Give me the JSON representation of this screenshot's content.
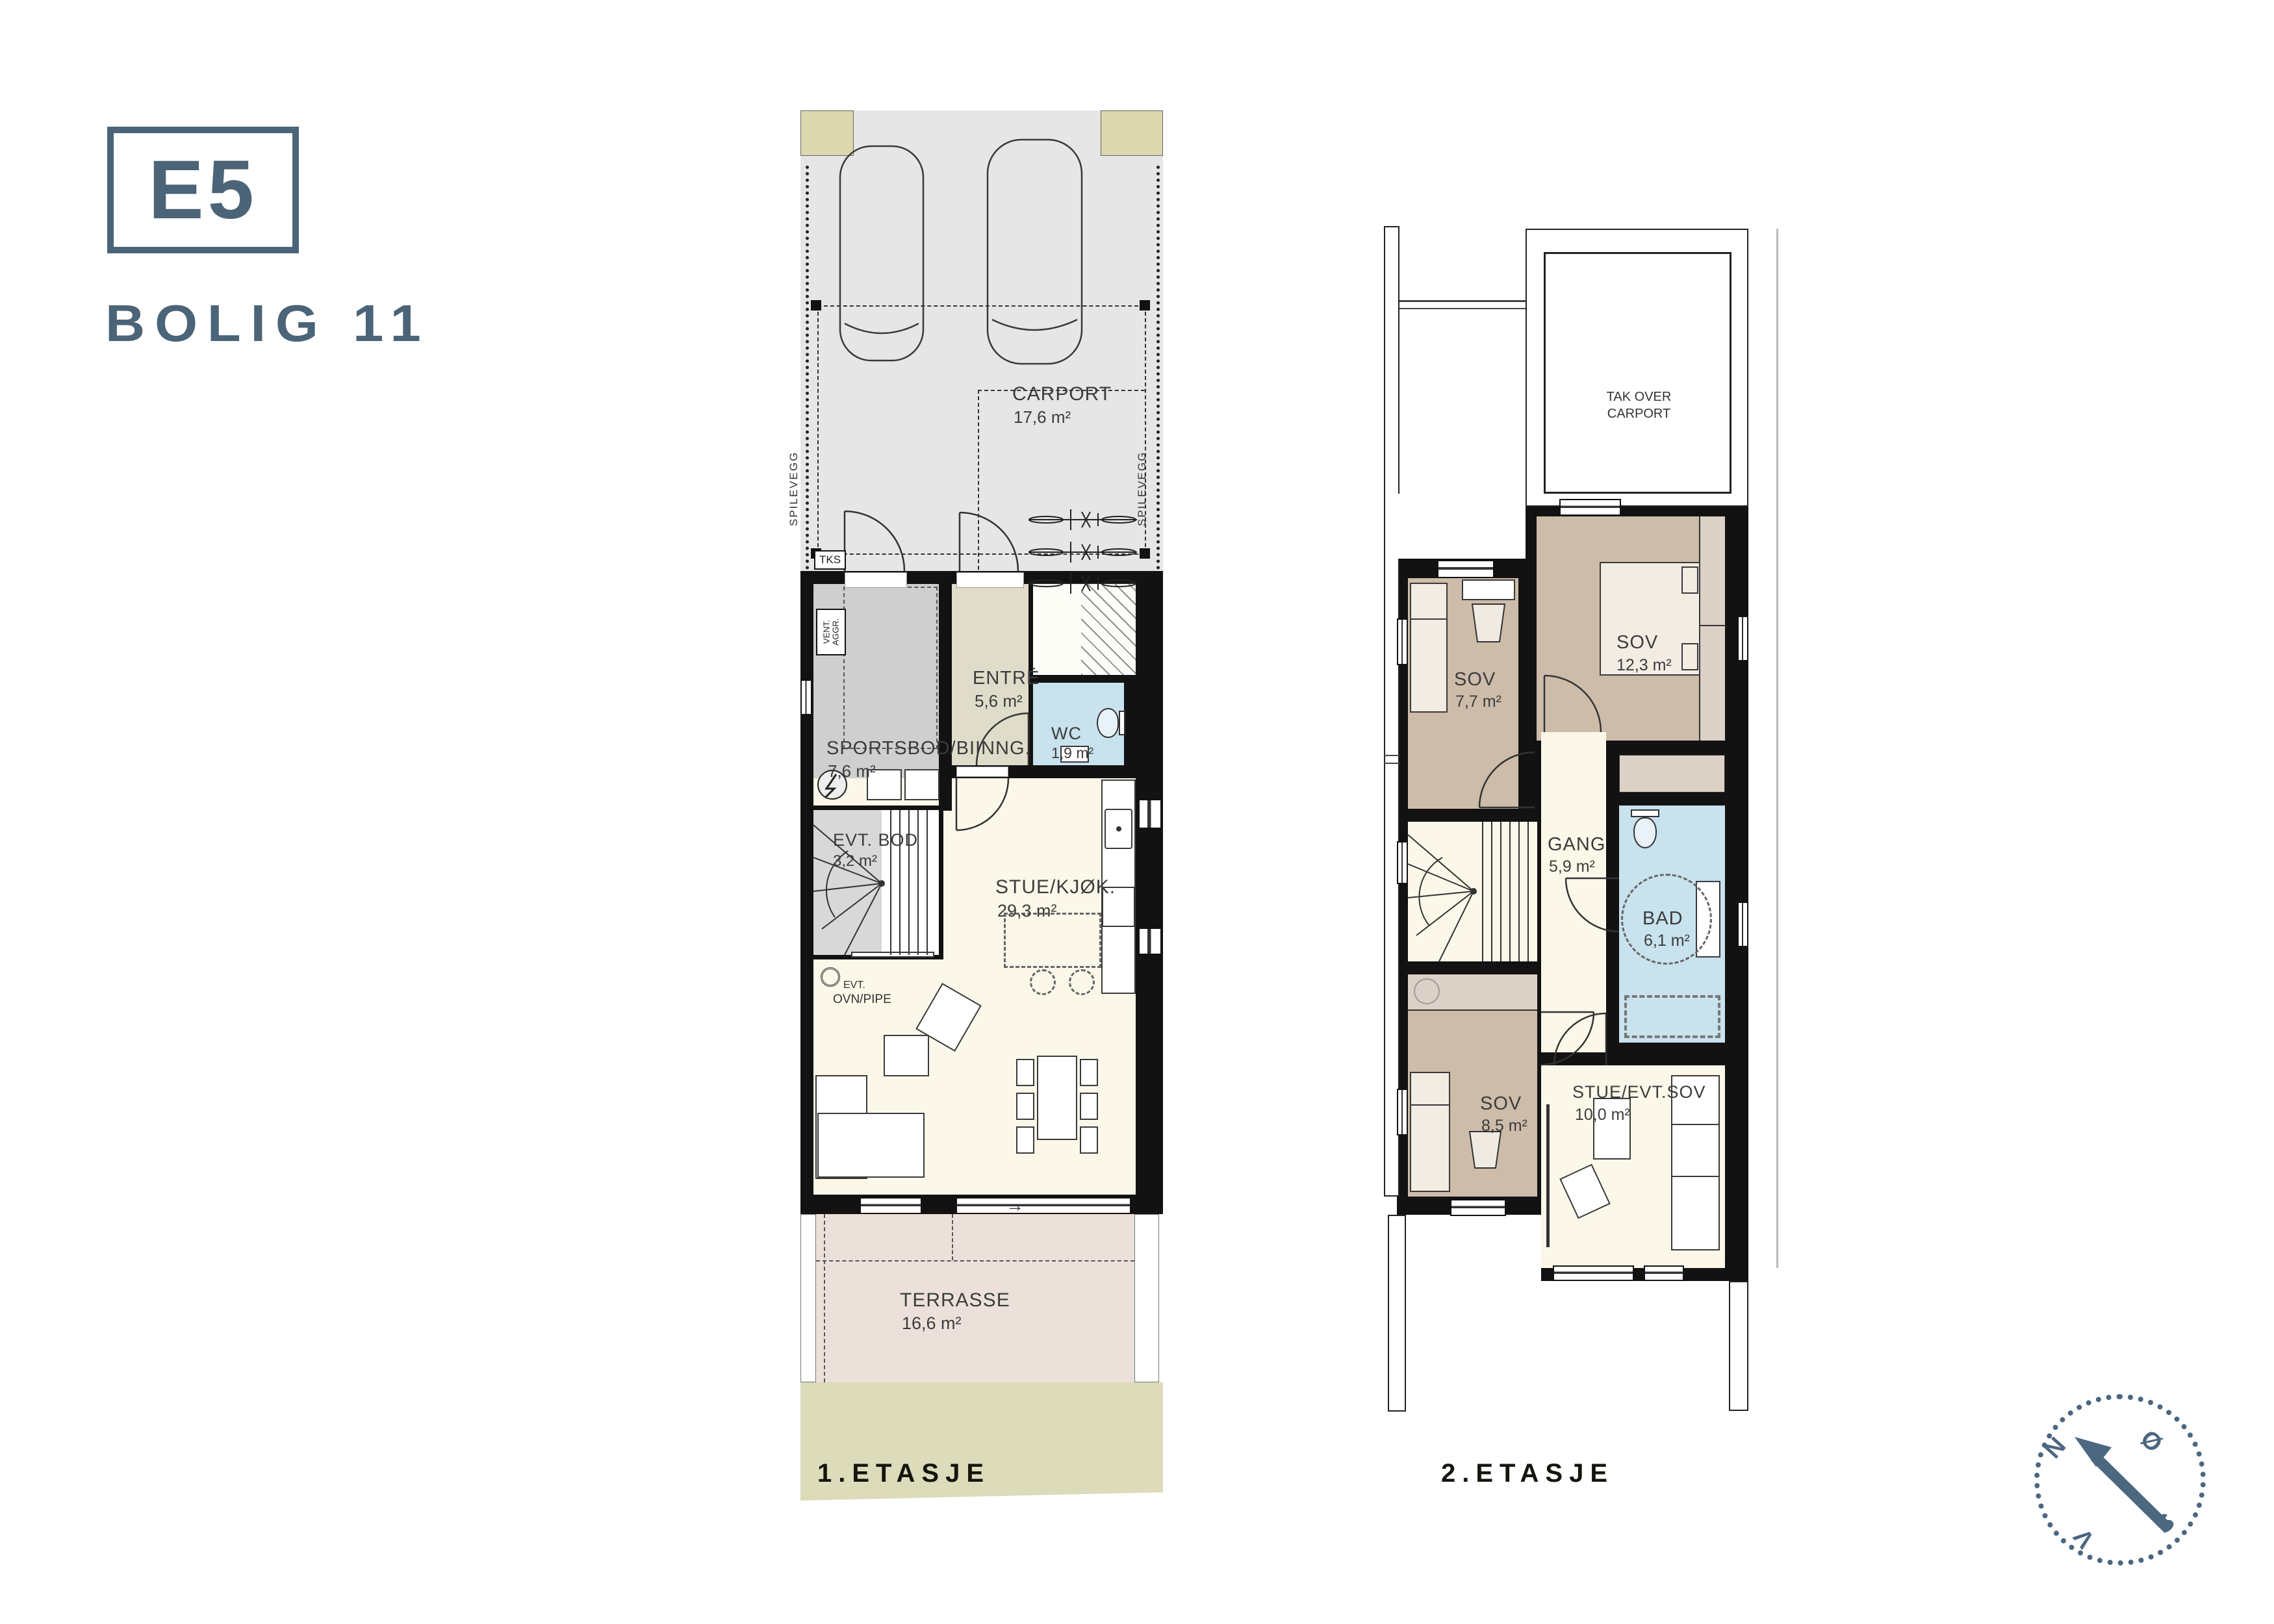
{
  "header": {
    "unit_code": "E5",
    "project_label": "BOLIG 11"
  },
  "floor1": {
    "label": "1.ETASJE",
    "rooms": {
      "carport": {
        "name": "CARPORT",
        "area": "17,6 m²"
      },
      "sportsbod": {
        "name": "SPORTSBOD/BIINNG.",
        "area": "7,6 m²"
      },
      "entre": {
        "name": "ENTRÉ",
        "area": "5,6 m²"
      },
      "wc": {
        "name": "WC",
        "area": "1,9 m²"
      },
      "evt_bod": {
        "name": "EVT. BOD",
        "area": "3,2 m²"
      },
      "stue_kjok": {
        "name": "STUE/KJØK.",
        "area": "29,3 m²"
      },
      "terrasse": {
        "name": "TERRASSE",
        "area": "16,6 m²"
      }
    },
    "annotations": {
      "spilevegg_left": "SPILEVEGG",
      "spilevegg_right": "SPILEVEGG",
      "tks": "TKS",
      "vent_line1": "VENT.",
      "vent_line2": "AGGR.",
      "evt": "EVT.",
      "ovn_pipe": "OVN/PIPE",
      "door_arrow": "→"
    }
  },
  "floor2": {
    "label": "2.ETASJE",
    "rooms": {
      "tak_over_carport": {
        "name": "TAK OVER CARPORT"
      },
      "sov_1": {
        "name": "SOV",
        "area": "7,7 m²"
      },
      "sov_2": {
        "name": "SOV",
        "area": "12,3 m²"
      },
      "gang": {
        "name": "GANG",
        "area": "5,9 m²"
      },
      "bad": {
        "name": "BAD",
        "area": "6,1 m²"
      },
      "sov_3": {
        "name": "SOV",
        "area": "8,5 m²"
      },
      "stue_evt_sov": {
        "name": "STUE/EVT.SOV",
        "area": "10,0 m²"
      }
    }
  },
  "compass": {
    "north": "N",
    "east": "Ø",
    "south": "S",
    "west": "V"
  },
  "colors": {
    "accent": "#4b6477",
    "wall": "#121212",
    "carport_floor": "#e6e6e6",
    "post_beige": "#dbd7ae",
    "floor_strip": "#dcdbba",
    "cream": "#fbf8e9",
    "tan": "#cdbcaa",
    "tan_light": "#dcd1c6",
    "wet_blue": "#c8e2ee",
    "storage_gray": "#cfcfcf",
    "entre_beige": "#dfdcca",
    "terrace_pink": "#ece1da"
  }
}
